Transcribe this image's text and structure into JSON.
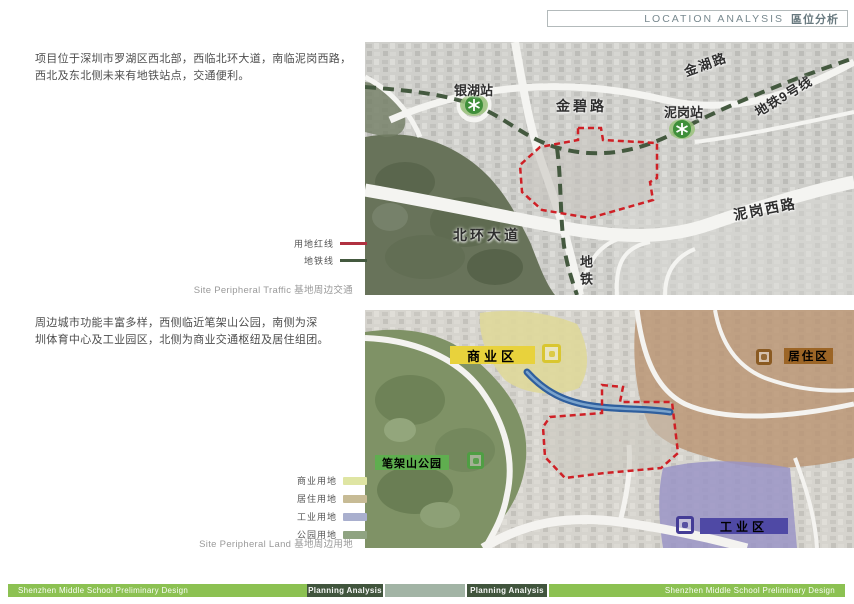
{
  "header": {
    "title_en": "LOCATION ANALYSIS",
    "title_zh": "區位分析"
  },
  "traffic_section": {
    "paragraph": [
      "项目位于深圳市罗湖区西北部，西临北环大道，南临泥岗西路，",
      "西北及东北侧未来有地铁站点，交通便利。"
    ],
    "legend": [
      {
        "label": "用地红线",
        "color": "#b03140"
      },
      {
        "label": "地铁线",
        "color": "#44593f"
      }
    ],
    "caption": "Site Peripheral Traffic 基地周边交通",
    "map_labels": {
      "yinhu_station": "银湖站",
      "jinbi_road": "金碧路",
      "jinhu_road": "金湖路",
      "nigang_station": "泥岗站",
      "metro_line_9": "地铁9号线",
      "nigang_west_road": "泥岗西路",
      "beihuan_avenue": "北环大道",
      "metro": "地铁"
    },
    "map_colors": {
      "site_boundary": "#cf2026",
      "metro_line": "#44593f",
      "station_icon": "#3f8f3a"
    }
  },
  "landuse_section": {
    "paragraph": [
      "周边城市功能丰富多样，西侧临近笔架山公园，南侧为深",
      "圳体育中心及工业园区，北侧为商业交通枢纽及居住组团。"
    ],
    "legend": [
      {
        "label": "商业用地",
        "color": "#dfe5a3"
      },
      {
        "label": "居住用地",
        "color": "#c7bb95"
      },
      {
        "label": "工业用地",
        "color": "#a9afce"
      },
      {
        "label": "公园用地",
        "color": "#8fa381"
      }
    ],
    "caption": "Site Peripheral Land 基地周边用地",
    "zones": [
      {
        "label": "商业区",
        "color": "#e8d23c",
        "icon_color": "#d9c630",
        "text_color": "#201c08"
      },
      {
        "label": "居住区",
        "color": "#9c6526",
        "icon_color": "#8a5a22",
        "text_color": "#2a1505"
      },
      {
        "label": "笔架山公园",
        "color": "#5fae4f",
        "icon_color": "#4f9e43",
        "text_color": "#103309"
      },
      {
        "label": "工业区",
        "color": "#4f49a5",
        "icon_color": "#443c96",
        "text_color": "#0d0d38"
      }
    ]
  },
  "footer": {
    "left_title": "Shenzhen Middle School Preliminary Design",
    "left_tab": "Planning Analysis",
    "right_tab": "Planning Analysis",
    "right_title": "Shenzhen Middle School Preliminary Design"
  }
}
